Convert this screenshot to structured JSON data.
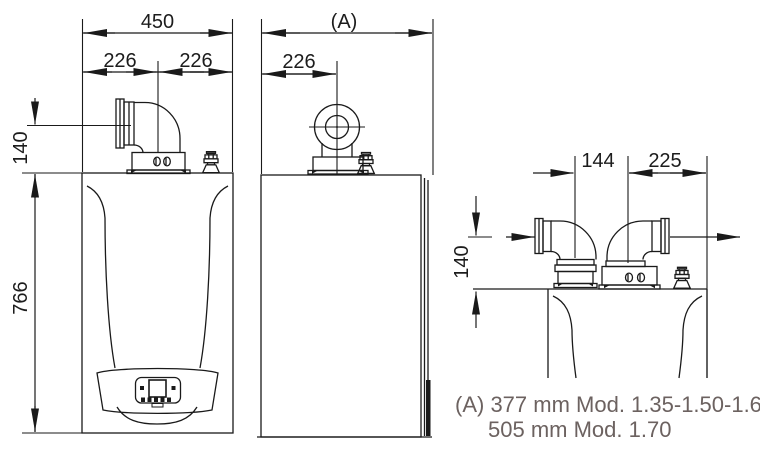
{
  "colors": {
    "line": "#1a1a1a",
    "note_text": "#6c6260",
    "background": "#ffffff"
  },
  "front_view": {
    "total_width": "450",
    "flue_offset_left": "226",
    "flue_offset_right": "226",
    "flue_center_height": "140",
    "body_height": "766"
  },
  "side_view": {
    "depth_label": "(A)",
    "flue_center_offset": "226"
  },
  "twin_flue_view": {
    "pipe_spacing": "144",
    "pipe_to_edge": "225",
    "flue_center_height": "140"
  },
  "note": {
    "line1": "(A) 377 mm Mod. 1.35-1.50-1.60",
    "line2": "505 mm Mod. 1.70"
  }
}
